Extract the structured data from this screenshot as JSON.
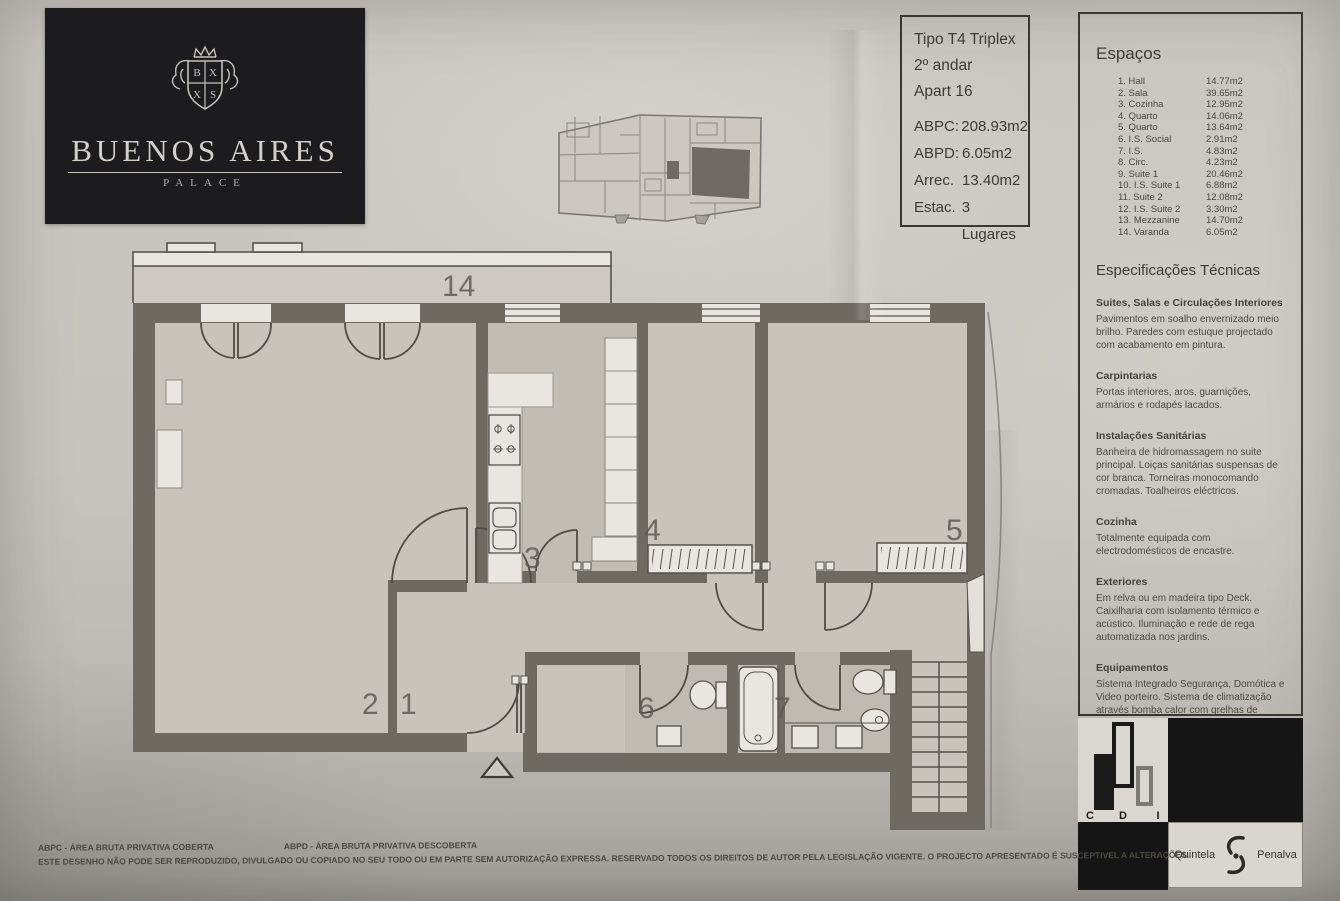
{
  "brand": {
    "name": "BUENOS AIRES",
    "subtitle": "PALACE"
  },
  "info_box": {
    "type": "Tipo T4 Triplex",
    "floor": "2º andar",
    "apartment": "Apart 16",
    "rows": [
      {
        "label": "ABPC:",
        "value": "208.93m2"
      },
      {
        "label": "ABPD:",
        "value": "6.05m2"
      },
      {
        "label": "Arrec.",
        "value": "13.40m2"
      },
      {
        "label": "Estac.",
        "value": "3 Lugares"
      }
    ]
  },
  "spaces": {
    "title": "Espaços",
    "items": [
      {
        "name": "1. Hall",
        "area": "14.77m2"
      },
      {
        "name": "2. Sala",
        "area": "39.65m2"
      },
      {
        "name": "3. Cozinha",
        "area": "12.95m2"
      },
      {
        "name": "4. Quarto",
        "area": "14.06m2"
      },
      {
        "name": "5. Quarto",
        "area": "13.64m2"
      },
      {
        "name": "6. I.S. Social",
        "area": "2.91m2"
      },
      {
        "name": "7. I.S.",
        "area": "4.83m2"
      },
      {
        "name": "8. Circ.",
        "area": "4.23m2"
      },
      {
        "name": "9. Suite 1",
        "area": "20.46m2"
      },
      {
        "name": "10. I.S. Suite 1",
        "area": "6.88m2"
      },
      {
        "name": "11. Suite 2",
        "area": "12.08m2"
      },
      {
        "name": "12. I.S. Suite 2",
        "area": "3.30m2"
      },
      {
        "name": "13. Mezzanine",
        "area": "14.70m2"
      },
      {
        "name": "14. Varanda",
        "area": "6.05m2"
      }
    ]
  },
  "specs": {
    "title": "Especificações Técnicas",
    "sections": [
      {
        "heading": "Suites, Salas e Circulações Interiores",
        "body": "Pavimentos em soalho envernizado meio brilho. Paredes com estuque projectado com acabamento em pintura."
      },
      {
        "heading": "Carpintarias",
        "body": "Portas interiores, aros, guarnições, armários e rodapés lacados."
      },
      {
        "heading": "Instalações Sanitárias",
        "body": "Banheira de hidromassagem no suite principal. Loiças sanitárias suspensas de cor branca. Torneiras monocomando cromadas. Toalheiros eléctricos."
      },
      {
        "heading": "Cozinha",
        "body": "Totalmente equipada com electrodomésticos de encastre."
      },
      {
        "heading": "Exteriores",
        "body": "Em relva ou em madeira tipo Deck. Caixilharia com isolamento térmico e acústico. Iluminação e rede de rega automatizada nos jardins."
      },
      {
        "heading": "Equipamentos",
        "body": "Sistema Integrado Segurança, Domótica e Video porteiro. Sistema de climatização através bomba calor com grelhas de distribuição nas paredes e tectos."
      }
    ]
  },
  "plan": {
    "labels": {
      "varanda": "14",
      "cozinha": "3",
      "quarto4": "4",
      "quarto5": "5",
      "sala": "2",
      "hall": "1",
      "is_social": "6",
      "is7": "7"
    }
  },
  "partners": {
    "cdi_c": "C",
    "cdi_d": "D",
    "cdi_i": "I",
    "quintela": "Quintela",
    "penalva": "Penalva"
  },
  "footer": {
    "abbr1": "ABPC - ÁREA BRUTA PRIVATIVA COBERTA",
    "abbr2": "ABPD - ÁREA BRUTA PRIVATIVA DESCOBERTA",
    "legal": "ESTE DESENHO NÃO PODE SER REPRODUZIDO, DIVULGADO OU COPIADO NO SEU TODO OU EM PARTE SEM AUTORIZAÇÃO EXPRESSA. RESERVADO TODOS OS DIREITOS DE AUTOR PELA LEGISLAÇÃO VIGENTE. O PROJECTO APRESENTADO É SUSCEPTIVEL A ALTERAÇÕES."
  },
  "colors": {
    "wall": "#6e6a62",
    "floor": "#c8c4bc",
    "paper": "#c7c3be",
    "logo_bg": "#1c1c1e"
  }
}
